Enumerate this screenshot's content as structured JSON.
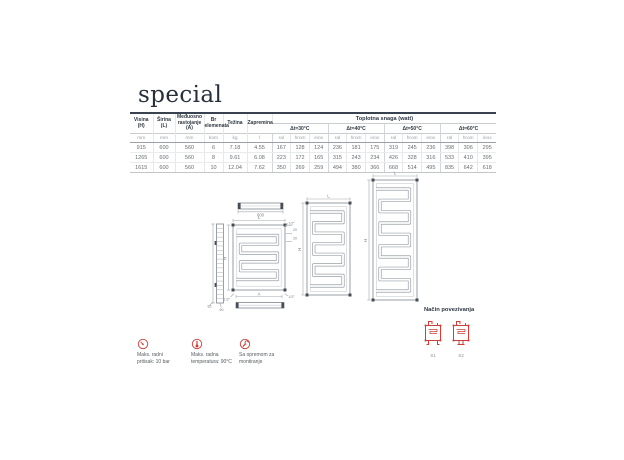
{
  "page": {
    "title": "special",
    "accent_color": "#c8413b",
    "title_color": "#25303c"
  },
  "table": {
    "headers": [
      "Visina\n(H)",
      "Širina\n(L)",
      "Međuosno\nrastojanje\n(A)",
      "Br\nelemenata",
      "Težina",
      "Zapremina"
    ],
    "group_header": "Toplotna snaga (watt)",
    "dt_groups": [
      "Δt=30°C",
      "Δt=40°C",
      "Δt=50°C",
      "Δt=60°C"
    ],
    "finish_cols": [
      "ral",
      "hrom",
      "inox"
    ],
    "units": [
      "mm",
      "mm",
      "mm",
      "kom",
      "kg",
      "l"
    ],
    "rows": [
      [
        "915",
        "600",
        "560",
        "6",
        "7.18",
        "4.55",
        "167",
        "128",
        "124",
        "236",
        "181",
        "175",
        "319",
        "245",
        "236",
        "398",
        "306",
        "295"
      ],
      [
        "1265",
        "600",
        "560",
        "8",
        "9.61",
        "6.08",
        "223",
        "172",
        "165",
        "315",
        "243",
        "234",
        "426",
        "328",
        "316",
        "533",
        "410",
        "395"
      ],
      [
        "1615",
        "600",
        "560",
        "10",
        "12.04",
        "7.62",
        "350",
        "269",
        "259",
        "494",
        "380",
        "366",
        "668",
        "514",
        "495",
        "835",
        "642",
        "618"
      ]
    ]
  },
  "drawings": {
    "top_view_width": "600",
    "length_label": "L",
    "height_label": "H",
    "axis_label": "A",
    "thread_label": "1/2\"",
    "offset_label": "20",
    "depth_label": "85",
    "bracket_label": "60"
  },
  "features": [
    {
      "icon": "gauge-icon",
      "lines": [
        "Maks. radni",
        "pritisak: 10 bar"
      ]
    },
    {
      "icon": "thermometer-icon",
      "lines": [
        "Maks. radna",
        "temperatura: 90°C"
      ]
    },
    {
      "icon": "wrench-icon",
      "lines": [
        "Sa opremom za",
        "montiranje"
      ]
    }
  ],
  "connections": {
    "title": "Način povezivanja",
    "items": [
      {
        "label": "S1"
      },
      {
        "label": "S2"
      }
    ]
  }
}
